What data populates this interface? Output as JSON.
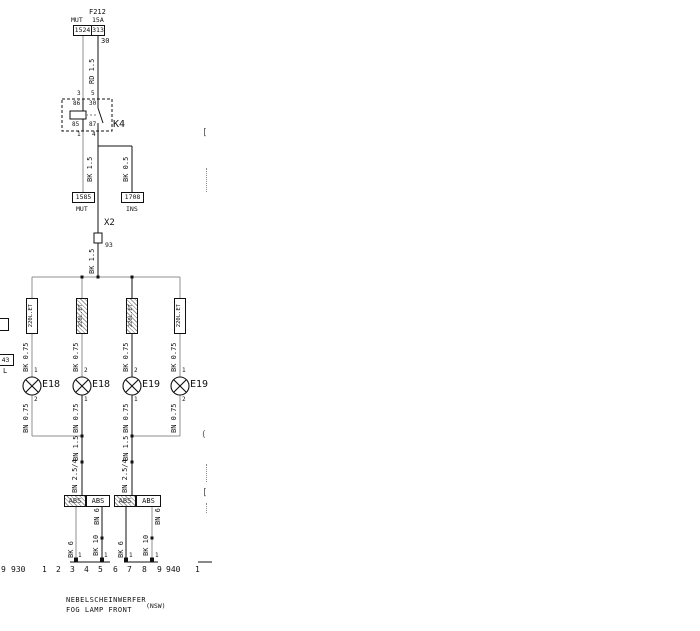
{
  "title_block": {
    "line1": "NEBELSCHEINWERFER",
    "line2": "FOG LAMP FRONT",
    "tag": "(NSW)"
  },
  "fuse": {
    "name": "F212",
    "rating": "15A",
    "top_label": "MUT",
    "box_left": "1524",
    "box_right": "313",
    "terminal": "30",
    "wire": "RD 1.5"
  },
  "relay": {
    "id": "K4",
    "pin_top_left_ext": "3",
    "pin_top_right_ext": "5",
    "pin_bottom_left_ext": "1",
    "pin_bottom_right_ext": "4",
    "coil_top": "86",
    "contact_top": "30",
    "coil_bottom": "85",
    "contact_bottom": "87"
  },
  "left_branch": {
    "wire": "BK 1.5",
    "box": "1585",
    "box_label": "MUT"
  },
  "right_branch": {
    "wire": "BK 0.5",
    "box": "1708",
    "box_label": "INS"
  },
  "x2": {
    "id": "X2",
    "pin": "93",
    "wire": "BK 1.5"
  },
  "lamps": [
    {
      "connector": "220L.ET",
      "wire_top": "BK 0.75",
      "pin_top": "1",
      "id": "E18",
      "pin_bottom": "2",
      "wire_bottom": "BN 0.75"
    },
    {
      "connector": "220L.ET",
      "wire_top": "BK 0.75",
      "pin_top": "2",
      "id": "E18",
      "pin_bottom": "1",
      "wire_bottom": "BN 0.75"
    },
    {
      "connector": "220L.ET",
      "wire_top": "BK 0.75",
      "pin_top": "2",
      "id": "E19",
      "pin_bottom": "1",
      "wire_bottom": "BN 0.75"
    },
    {
      "connector": "220L.ET",
      "wire_top": "BK 0.75",
      "pin_top": "1",
      "id": "E19",
      "pin_bottom": "2",
      "wire_bottom": "BN 0.75"
    }
  ],
  "ground_runs": [
    {
      "wire1": "BN 1.5",
      "wire2": "BN 2.5/4"
    },
    {
      "wire1": "BN 1.5",
      "wire2": "BN 2.5/4"
    }
  ],
  "abs_connectors": {
    "boxes": [
      "ABS",
      "ABS",
      "ABS",
      "ABS"
    ],
    "wires": [
      {
        "label": "BK 6",
        "pin": "1"
      },
      {
        "label_top": "BN 6",
        "label_bottom": "BK 10",
        "pin": "1"
      },
      {
        "label": "BK 6",
        "pin": "1"
      },
      {
        "label_top": "BN 6",
        "label_bottom": "BK 10",
        "pin": "1"
      }
    ]
  },
  "edge_left": {
    "box_text": "43",
    "text": "L"
  },
  "edge_right": {
    "bracket1": "[",
    "paren": "(",
    "bracket2": "["
  },
  "track": {
    "cells": [
      "9",
      "930",
      "1",
      "2",
      "3",
      "4",
      "5",
      "6",
      "7",
      "8",
      "9",
      "940",
      "1"
    ]
  }
}
